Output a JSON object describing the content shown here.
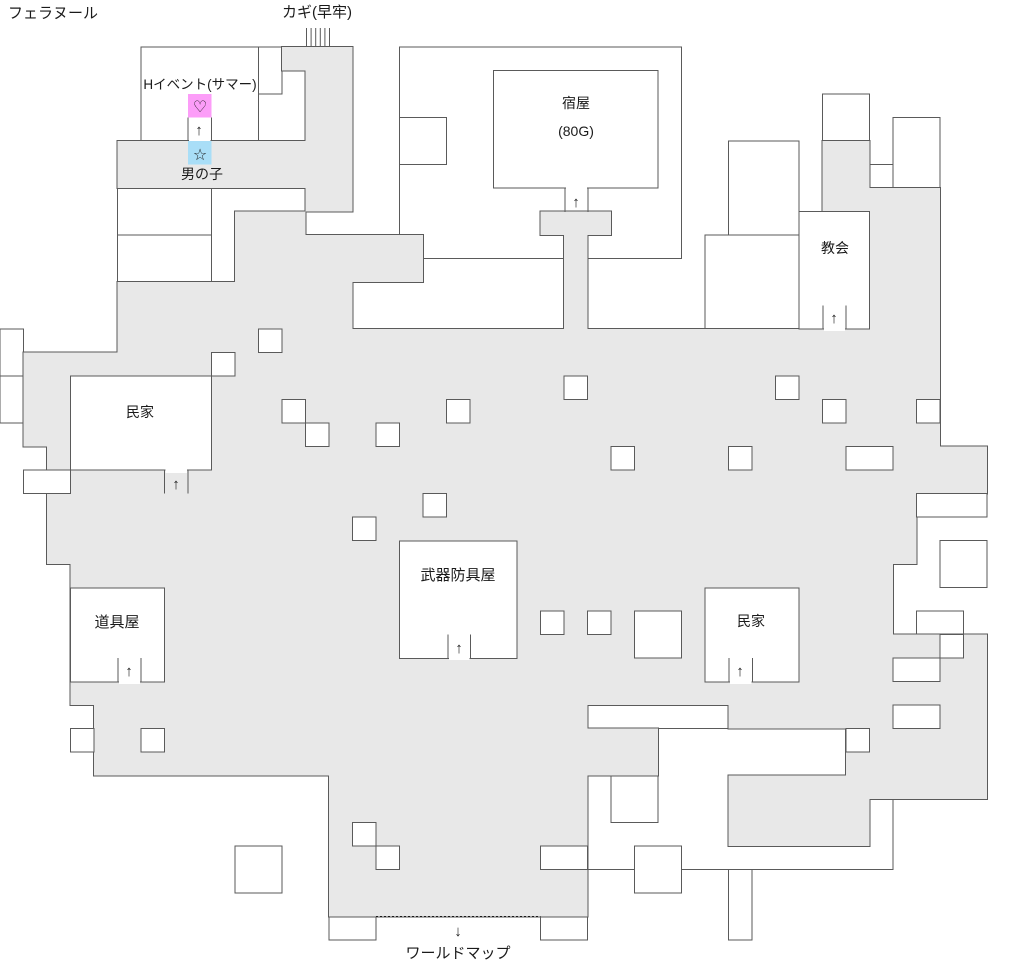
{
  "town_name": "フェラヌール",
  "colors": {
    "background": "#ffffff",
    "path_fill": "#e8e8e8",
    "wall": "#5a5a5a",
    "text": "#1a1a1a",
    "event_pink": "#fc9df8",
    "event_blue": "#a9def7"
  },
  "grid_unit": 23.5,
  "labels": [
    {
      "name": "town-name",
      "text": "フェラヌール",
      "x": 8,
      "y": 18,
      "size": 15,
      "anchor": "start"
    },
    {
      "name": "jail-key-label",
      "text": "カギ(早牢)",
      "x": 317,
      "y": 17,
      "size": 15,
      "anchor": "middle"
    },
    {
      "name": "h-event-label",
      "text": "Hイベント(サマー)",
      "x": 200,
      "y": 89,
      "size": 13.5,
      "anchor": "middle"
    },
    {
      "name": "boy-label",
      "text": "男の子",
      "x": 202,
      "y": 179,
      "size": 14,
      "anchor": "middle"
    },
    {
      "name": "inn-label",
      "text": "宿屋",
      "x": 576,
      "y": 108,
      "size": 14,
      "anchor": "middle"
    },
    {
      "name": "inn-price-label",
      "text": "(80G)",
      "x": 576,
      "y": 136,
      "size": 14,
      "anchor": "middle"
    },
    {
      "name": "church-label",
      "text": "教会",
      "x": 835,
      "y": 253,
      "size": 14,
      "anchor": "middle"
    },
    {
      "name": "house-left-label",
      "text": "民家",
      "x": 140,
      "y": 417,
      "size": 14,
      "anchor": "middle"
    },
    {
      "name": "item-shop-label",
      "text": "道具屋",
      "x": 117,
      "y": 627,
      "size": 15,
      "anchor": "middle"
    },
    {
      "name": "weapon-armor-shop-label",
      "text": "武器防具屋",
      "x": 458,
      "y": 580,
      "size": 15,
      "anchor": "middle"
    },
    {
      "name": "house-right-label",
      "text": "民家",
      "x": 751,
      "y": 626,
      "size": 14,
      "anchor": "middle"
    },
    {
      "name": "world-map-label",
      "text": "ワールドマップ",
      "x": 458,
      "y": 958,
      "size": 15,
      "anchor": "middle"
    }
  ],
  "map": {
    "gray_rects": [
      [
        12,
        2,
        3,
        1
      ],
      [
        13,
        3,
        2,
        6
      ],
      [
        5,
        6,
        8,
        2
      ],
      [
        10,
        9,
        3,
        3
      ],
      [
        23,
        9,
        3,
        1
      ],
      [
        24,
        10,
        1,
        4
      ],
      [
        35,
        6,
        2,
        3
      ],
      [
        37,
        8,
        3,
        3
      ],
      [
        37,
        11,
        3,
        3
      ],
      [
        12,
        10,
        6,
        2
      ],
      [
        5,
        12,
        10,
        3
      ],
      [
        29,
        14,
        11,
        3
      ],
      [
        5,
        14,
        25,
        3
      ],
      [
        1,
        15,
        6,
        4
      ],
      [
        2,
        17,
        38,
        4
      ],
      [
        40,
        19,
        2,
        2
      ],
      [
        2,
        21,
        37,
        3
      ],
      [
        3,
        24,
        35,
        3
      ],
      [
        3,
        27,
        39,
        3
      ],
      [
        31,
        29,
        11,
        2
      ],
      [
        36,
        29,
        6,
        5
      ],
      [
        4,
        30,
        10,
        3
      ],
      [
        14,
        30,
        11,
        9
      ],
      [
        25,
        31,
        3,
        2
      ],
      [
        31,
        33,
        6,
        3
      ]
    ],
    "hole_rects": [
      [
        11,
        14,
        1,
        1
      ],
      [
        9,
        15,
        1,
        1
      ],
      [
        24,
        16,
        1,
        1
      ],
      [
        33,
        16,
        1,
        1
      ],
      [
        12,
        17,
        1,
        1
      ],
      [
        19,
        17,
        1,
        1
      ],
      [
        35,
        17,
        1,
        1
      ],
      [
        39,
        17,
        1,
        1
      ],
      [
        13,
        18,
        1,
        1
      ],
      [
        16,
        18,
        1,
        1
      ],
      [
        26,
        19,
        1,
        1
      ],
      [
        31,
        19,
        1,
        1
      ],
      [
        36,
        19,
        2,
        1
      ],
      [
        1,
        20,
        2,
        1
      ],
      [
        18,
        21,
        1,
        1
      ],
      [
        39,
        21,
        3,
        1
      ],
      [
        15,
        22,
        1,
        1
      ],
      [
        23,
        26,
        1,
        1
      ],
      [
        25,
        26,
        1,
        1
      ],
      [
        27,
        26,
        2,
        2
      ],
      [
        40,
        27,
        1,
        1
      ],
      [
        38,
        28,
        2,
        1
      ],
      [
        3,
        31,
        1,
        1
      ],
      [
        6,
        31,
        1,
        1
      ],
      [
        38,
        30,
        2,
        1
      ],
      [
        36,
        31,
        1,
        1
      ],
      [
        15,
        35,
        1,
        1
      ],
      [
        16,
        36,
        1,
        1
      ],
      [
        23,
        36,
        2,
        1
      ]
    ],
    "room_rects": [
      [
        6,
        2,
        5,
        4
      ],
      [
        11,
        2,
        1,
        2
      ],
      [
        17,
        2,
        12,
        9
      ],
      [
        17,
        5,
        2,
        2
      ],
      [
        5,
        8,
        4,
        2
      ],
      [
        5,
        10,
        4,
        2
      ],
      [
        31,
        6,
        3,
        4
      ],
      [
        35,
        4,
        2,
        2
      ],
      [
        38,
        5,
        2,
        3
      ],
      [
        36,
        7,
        2,
        2
      ],
      [
        30,
        10,
        4,
        4
      ],
      [
        0,
        14,
        1,
        2
      ],
      [
        0,
        16,
        1,
        2
      ],
      [
        34,
        19,
        3,
        3
      ],
      [
        40,
        23,
        2,
        2
      ],
      [
        39,
        26,
        2,
        2
      ],
      [
        35,
        28,
        3,
        3
      ],
      [
        25,
        31,
        13,
        6
      ],
      [
        31,
        37,
        1,
        3
      ],
      [
        26,
        33,
        2,
        2
      ],
      [
        27,
        36,
        2,
        2
      ],
      [
        10,
        36,
        2,
        2
      ],
      [
        14,
        39,
        2,
        1
      ],
      [
        23,
        39,
        2,
        1
      ]
    ],
    "buildings": [
      {
        "name": "inn",
        "rect": [
          493.5,
          70.5,
          164.5,
          117.5
        ],
        "door": {
          "jambs": [
            [
              565,
              188,
              565,
              212
            ],
            [
              588,
              188,
              588,
              212
            ]
          ],
          "gap": [
            566,
            186,
            21,
            5
          ],
          "glyph": "↑",
          "arrow": [
            576,
            207
          ]
        }
      },
      {
        "name": "church",
        "rect": [
          799,
          211.5,
          70.5,
          117.5
        ],
        "door": {
          "jambs": [
            [
              823,
              305.5,
              823,
              329
            ],
            [
              846,
              305.5,
              846,
              329
            ]
          ],
          "gap": [
            824,
            326,
            21,
            5
          ],
          "glyph": "↑",
          "arrow": [
            834,
            323
          ]
        }
      },
      {
        "name": "house-left",
        "rect": [
          70.5,
          376,
          141,
          94
        ],
        "door": {
          "jambs": [
            [
              164.5,
              470,
              164.5,
              493.5
            ],
            [
              188,
              470,
              188,
              493.5
            ]
          ],
          "gap": [
            165.5,
            468,
            21.5,
            5
          ],
          "glyph": "↑",
          "arrow": [
            176,
            489
          ]
        }
      },
      {
        "name": "item-shop",
        "rect": [
          70.5,
          588,
          94,
          94
        ],
        "door": {
          "jambs": [
            [
              118,
              658,
              118,
              682
            ],
            [
              141,
              658,
              141,
              682
            ]
          ],
          "gap": [
            119,
            679,
            21,
            5
          ],
          "glyph": "↑",
          "arrow": [
            129,
            676
          ]
        }
      },
      {
        "name": "weapon-armor-shop",
        "rect": [
          399.5,
          541,
          117.5,
          117.5
        ],
        "door": {
          "jambs": [
            [
              448,
              634.5,
              448,
              658
            ],
            [
              470.5,
              634.5,
              470.5,
              658
            ]
          ],
          "gap": [
            449,
            655,
            20.5,
            5
          ],
          "glyph": "↑",
          "arrow": [
            459,
            653
          ]
        }
      },
      {
        "name": "house-right",
        "rect": [
          705,
          588,
          94,
          94
        ],
        "door": {
          "jambs": [
            [
              729,
              658,
              729,
              682
            ],
            [
              752.5,
              658,
              752.5,
              682
            ]
          ],
          "gap": [
            730,
            679,
            21.5,
            5
          ],
          "glyph": "↑",
          "arrow": [
            740,
            676
          ]
        }
      },
      {
        "name": "h-event-room",
        "rect": null,
        "door": {
          "jambs": [
            [
              188,
              117.5,
              188,
              141
            ],
            [
              211.5,
              117.5,
              211.5,
              141
            ]
          ],
          "gap": [
            189,
            139,
            21.5,
            4
          ],
          "glyph": "↑",
          "arrow": [
            199,
            135
          ]
        }
      }
    ],
    "markers": {
      "event_heart_cell": {
        "rect": [
          188,
          94,
          23.5,
          23.5
        ],
        "glyph": "♡",
        "color_key": "event_pink",
        "glyph_xy": [
          200,
          112
        ]
      },
      "event_star_cell": {
        "rect": [
          188,
          141,
          23.5,
          23.5
        ],
        "glyph": "☆",
        "color_key": "event_blue",
        "glyph_xy": [
          200,
          160
        ]
      },
      "jail_bars": {
        "x_start": 306.5,
        "y_top": 28,
        "y_bottom": 46,
        "count": 6,
        "spacing": 4.6
      },
      "world_exit": {
        "dotted_line": [
          376,
          916.5,
          540.5,
          916.5
        ],
        "glyph": "↓",
        "glyph_xy": [
          458,
          936
        ]
      }
    }
  }
}
